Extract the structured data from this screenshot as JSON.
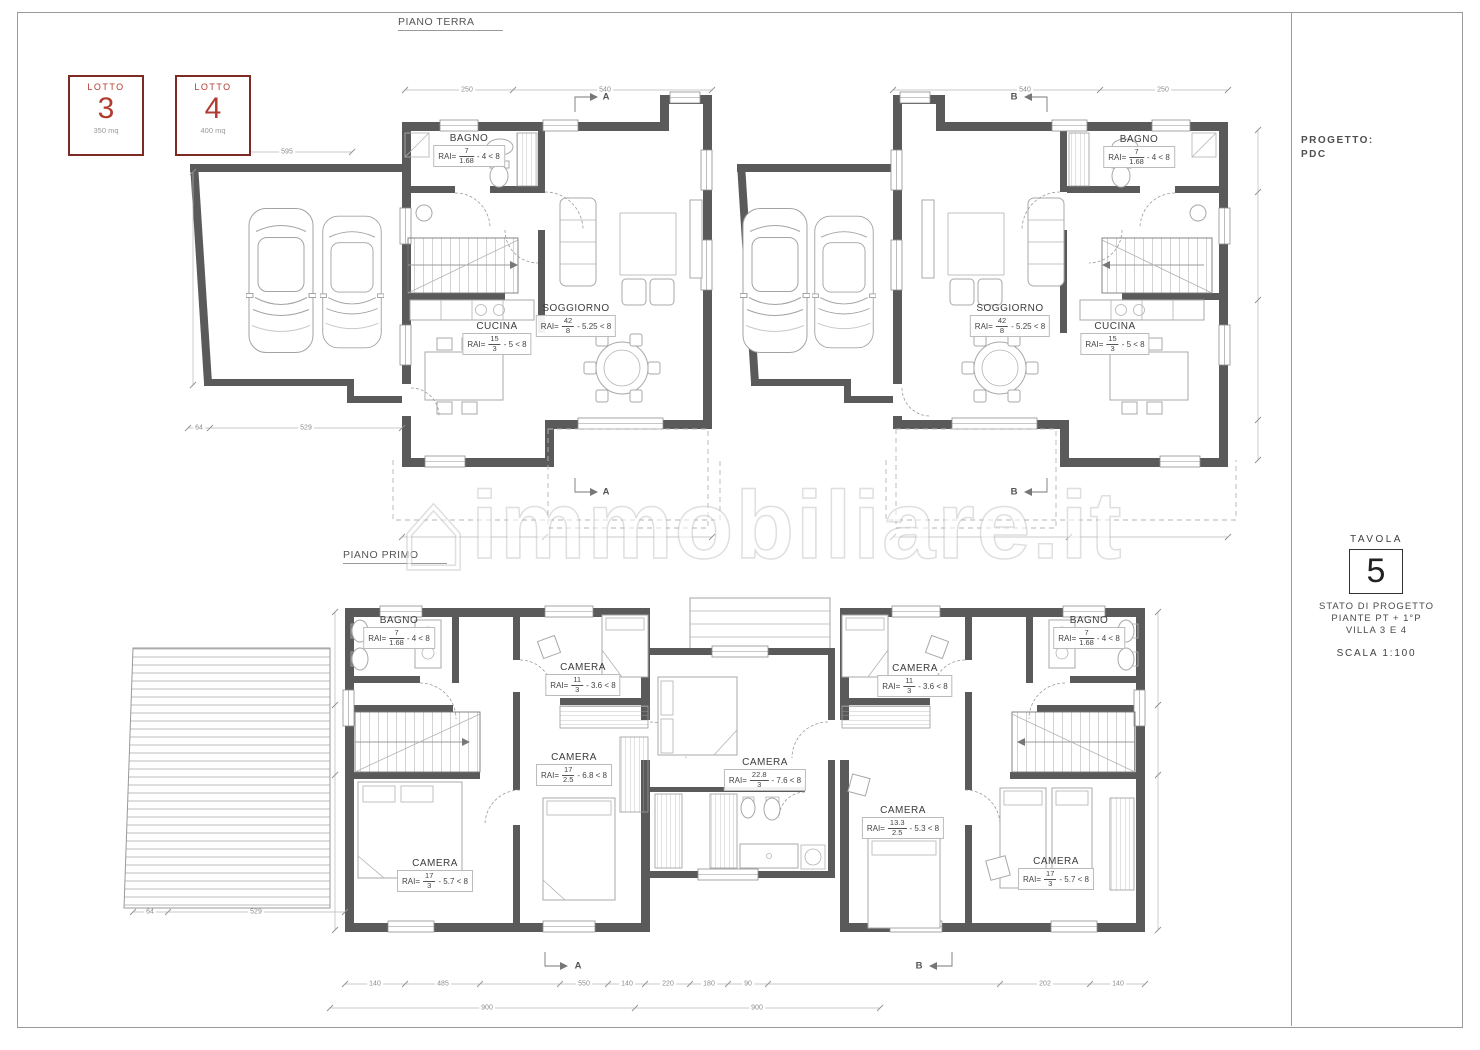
{
  "floors": {
    "ground": "PIANO TERRA",
    "first": "PIANO PRIMO"
  },
  "lots": [
    {
      "label": "LOTTO",
      "number": "3",
      "area": "350 mq",
      "x": 68,
      "y": 75
    },
    {
      "label": "LOTTO",
      "number": "4",
      "area": "400 mq",
      "x": 175,
      "y": 75
    }
  ],
  "title_block": {
    "project_label": "PROGETTO:",
    "project_value": "PDC",
    "tavola_label": "TAVOLA",
    "tavola_number": "5",
    "state_line1": "STATO DI PROGETTO",
    "state_line2": "PIANTE PT + 1°P",
    "state_line3": "VILLA 3 E 4",
    "scale": "SCALA 1:100"
  },
  "watermark": {
    "text": "immobiliare.it",
    "house_icon": "⌂"
  },
  "rai_prefix": "RAI=",
  "rooms": [
    {
      "floor": "pt",
      "name": "BAGNO",
      "num": "7",
      "den": "1.68",
      "check": "4 < 8",
      "x": 469,
      "y": 133
    },
    {
      "floor": "pt",
      "name": "SOGGIORNO",
      "num": "42",
      "den": "8",
      "check": "5.25 < 8",
      "x": 576,
      "y": 303
    },
    {
      "floor": "pt",
      "name": "CUCINA",
      "num": "15",
      "den": "3",
      "check": "5 < 8",
      "x": 497,
      "y": 321
    },
    {
      "floor": "pt",
      "name": "SOGGIORNO",
      "num": "42",
      "den": "8",
      "check": "5.25 < 8",
      "x": 1010,
      "y": 303
    },
    {
      "floor": "pt",
      "name": "CUCINA",
      "num": "15",
      "den": "3",
      "check": "5 < 8",
      "x": 1115,
      "y": 321
    },
    {
      "floor": "pt",
      "name": "BAGNO",
      "num": "7",
      "den": "1.68",
      "check": "4 < 8",
      "x": 1139,
      "y": 134
    },
    {
      "floor": "pp",
      "name": "BAGNO",
      "num": "7",
      "den": "1.68",
      "check": "4 < 8",
      "x": 399,
      "y": 615
    },
    {
      "floor": "pp",
      "name": "CAMERA",
      "num": "11",
      "den": "3",
      "check": "3.6 < 8",
      "x": 583,
      "y": 662
    },
    {
      "floor": "pp",
      "name": "CAMERA",
      "num": "17",
      "den": "2.5",
      "check": "6.8 < 8",
      "x": 574,
      "y": 752
    },
    {
      "floor": "pp",
      "name": "CAMERA",
      "num": "22.8",
      "den": "3",
      "check": "7.6 < 8",
      "x": 765,
      "y": 757
    },
    {
      "floor": "pp",
      "name": "CAMERA",
      "num": "17",
      "den": "3",
      "check": "5.7 < 8",
      "x": 435,
      "y": 858
    },
    {
      "floor": "pp",
      "name": "CAMERA",
      "num": "11",
      "den": "3",
      "check": "3.6 < 8",
      "x": 915,
      "y": 663
    },
    {
      "floor": "pp",
      "name": "BAGNO",
      "num": "7",
      "den": "1.68",
      "check": "4 < 8",
      "x": 1089,
      "y": 615
    },
    {
      "floor": "pp",
      "name": "CAMERA",
      "num": "13.3",
      "den": "2.5",
      "check": "5.3 < 8",
      "x": 903,
      "y": 805
    },
    {
      "floor": "pp",
      "name": "CAMERA",
      "num": "17",
      "den": "3",
      "check": "5.7 < 8",
      "x": 1056,
      "y": 856
    }
  ],
  "dimensions": [
    {
      "text": "595",
      "x": 287,
      "y": 152
    },
    {
      "text": "250",
      "x": 467,
      "y": 90
    },
    {
      "text": "540",
      "x": 605,
      "y": 90
    },
    {
      "text": "540",
      "x": 1025,
      "y": 90
    },
    {
      "text": "250",
      "x": 1163,
      "y": 90
    },
    {
      "text": "64",
      "x": 199,
      "y": 428
    },
    {
      "text": "529",
      "x": 306,
      "y": 428
    },
    {
      "text": "64",
      "x": 150,
      "y": 912
    },
    {
      "text": "529",
      "x": 256,
      "y": 912
    },
    {
      "text": "140",
      "x": 375,
      "y": 984
    },
    {
      "text": "485",
      "x": 443,
      "y": 984
    },
    {
      "text": "550",
      "x": 584,
      "y": 984
    },
    {
      "text": "140",
      "x": 627,
      "y": 984
    },
    {
      "text": "220",
      "x": 668,
      "y": 984
    },
    {
      "text": "180",
      "x": 709,
      "y": 984
    },
    {
      "text": "90",
      "x": 748,
      "y": 984
    },
    {
      "text": "202",
      "x": 1045,
      "y": 984
    },
    {
      "text": "140",
      "x": 1118,
      "y": 984
    },
    {
      "text": "900",
      "x": 487,
      "y": 1008
    },
    {
      "text": "900",
      "x": 757,
      "y": 1008
    }
  ],
  "section_marks": [
    {
      "t": "A",
      "x": 606,
      "y": 97
    },
    {
      "t": "A",
      "x": 606,
      "y": 492
    },
    {
      "t": "B",
      "x": 1014,
      "y": 97
    },
    {
      "t": "B",
      "x": 1014,
      "y": 492
    },
    {
      "t": "A",
      "x": 578,
      "y": 966
    },
    {
      "t": "B",
      "x": 919,
      "y": 966
    }
  ],
  "colors": {
    "wall_gray": "#5a5a5a",
    "lot_red": "#b23b30",
    "lot_border_red": "#7e2a24",
    "line_gray": "#9b9b9b"
  }
}
